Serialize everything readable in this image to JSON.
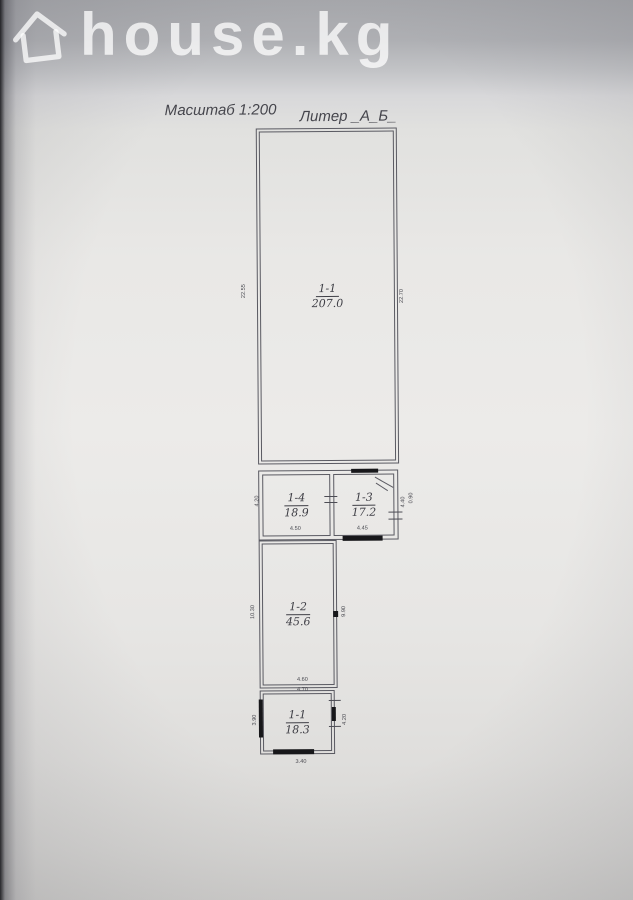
{
  "watermark": {
    "brand": "house.kg"
  },
  "plan": {
    "scale_label": "Масштаб 1:200",
    "liter_label": "Литер _А_Б_",
    "rooms": [
      {
        "number": "1-1",
        "area": "207.0"
      },
      {
        "number": "1-4",
        "area": "18.9"
      },
      {
        "number": "1-3",
        "area": "17.2"
      },
      {
        "number": "1-2",
        "area": "45.6"
      },
      {
        "number": "1-1",
        "area": "18.3"
      }
    ],
    "dims": {
      "top_left": "22.55",
      "top_right": "22.70",
      "mid_left": "4.20",
      "mid_right_a": "4.40",
      "mid_right_b": "0.90",
      "r14_bottom": "4.50",
      "r13_bottom": "4.45",
      "r12_left": "10.30",
      "r12_right": "9.90",
      "r12_bottom": "4.60",
      "r11_top": "4.70",
      "r11_left": "3.90",
      "r11_right": "4.20",
      "r11_bottom": "3.40"
    },
    "colors": {
      "line": "#5a5a62",
      "wall_fill": "#17171a",
      "label_text": "#3f3f46"
    }
  }
}
